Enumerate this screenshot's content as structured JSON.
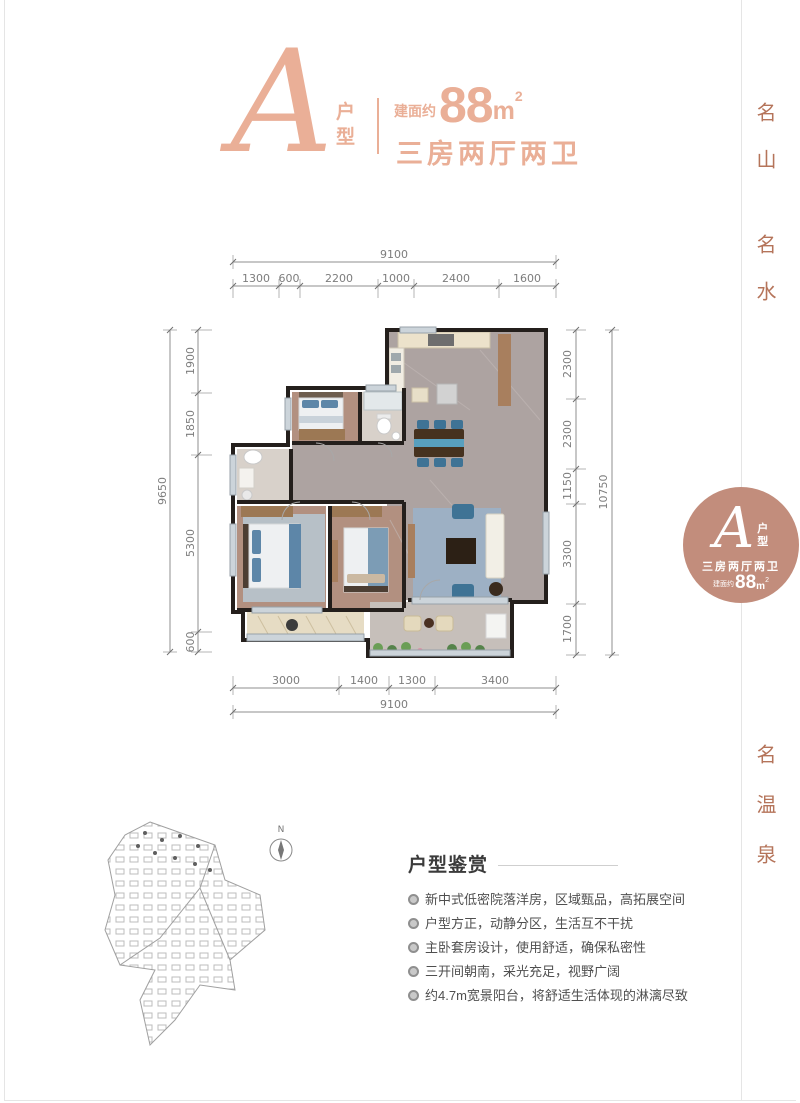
{
  "header": {
    "type_letter": "A",
    "type_char_1": "户",
    "type_char_2": "型",
    "area_prefix": "建面约",
    "area_value": "88",
    "area_unit": "m",
    "area_exp": "2",
    "layout": "三房两厅两卫"
  },
  "side_texts": {
    "top_1": "名山",
    "top_2": "名水",
    "bottom": "名温泉"
  },
  "badge": {
    "letter": "A",
    "type_char_1": "户",
    "type_char_2": "型",
    "layout": "三房两厅两卫",
    "area_prefix": "建面约",
    "area_value": "88",
    "area_unit": "m",
    "area_exp": "2"
  },
  "dimensions": {
    "top": {
      "total": "9100",
      "segments": [
        "1300",
        "600",
        "2200",
        "1000",
        "2400",
        "1600"
      ]
    },
    "left": {
      "total": "9650",
      "segments": [
        "1900",
        "1850",
        "5300",
        "600"
      ]
    },
    "right": {
      "total": "10750",
      "segments": [
        "2300",
        "2300",
        "1150",
        "3300",
        "1700"
      ]
    },
    "bottom": {
      "total": "9100",
      "segments": [
        "3000",
        "1400",
        "1300",
        "3400"
      ]
    }
  },
  "compass": {
    "label": "N"
  },
  "features": {
    "title": "户型鉴赏",
    "items": [
      "新中式低密院落洋房，区域甄品，高拓展空间",
      "户型方正，动静分区，生活互不干扰",
      "主卧套房设计，使用舒适，确保私密性",
      "三开间朝南，采光充足，视野广阔",
      "约4.7m宽景阳台，将舒适生活体现的淋漓尽致"
    ]
  },
  "colors": {
    "accent_salmon": "#EAAF97",
    "accent_terracotta": "#B5745A",
    "badge_fill": "#C28D7C",
    "wall_dark": "#241F1C",
    "dim_gray": "#8F8F8F",
    "text_dark": "#3B3B3B"
  }
}
